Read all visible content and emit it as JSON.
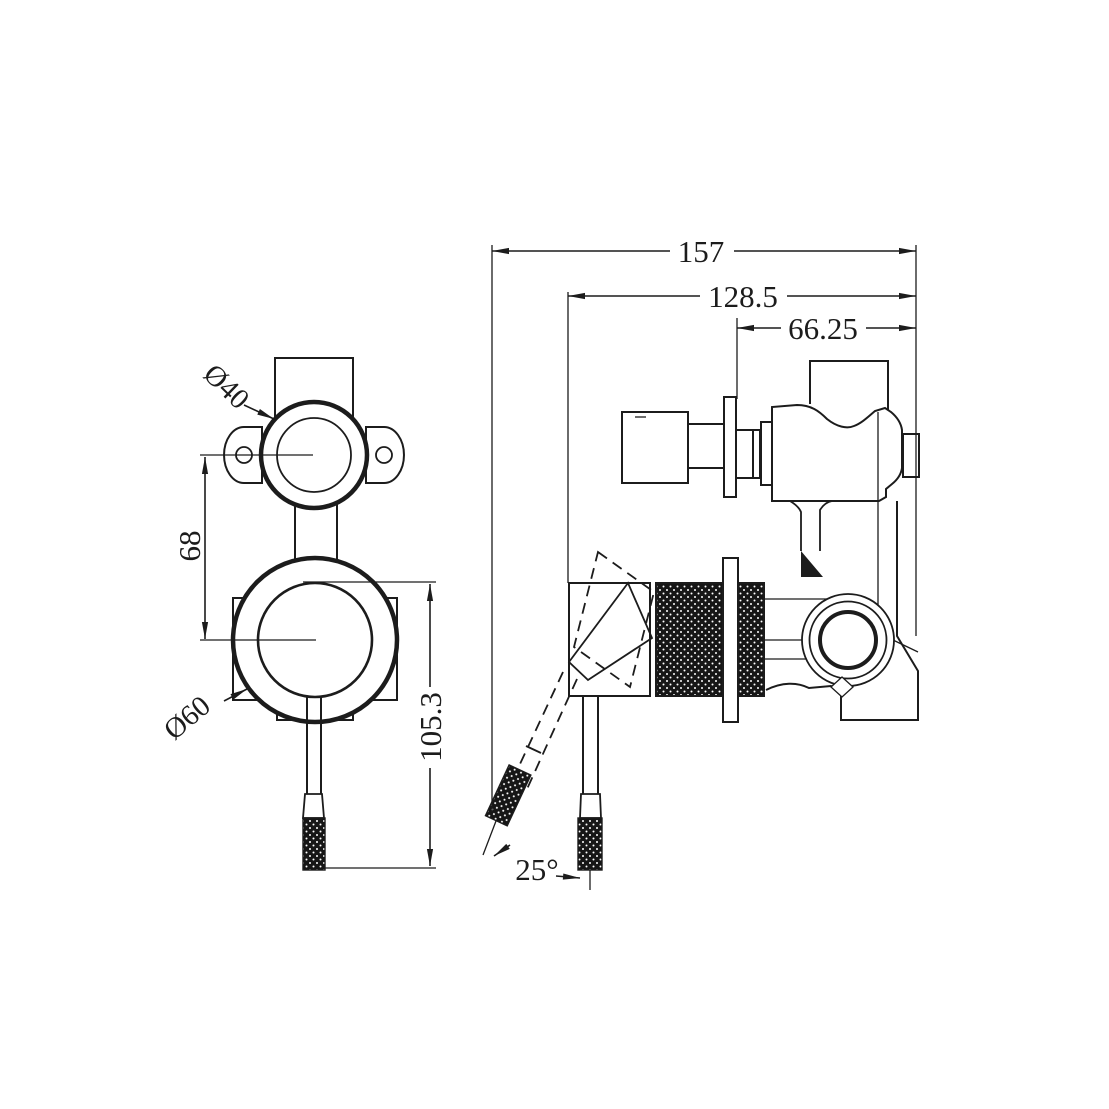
{
  "page": {
    "background": "#ffffff",
    "ink": "#1c1c1c"
  },
  "drawing": {
    "type": "technical-orthographic-drawing",
    "subject": "wall-mounted-mixer-with-diverter",
    "dimensions": {
      "overall_depth": "157",
      "handle_plate_depth": "128.5",
      "wall_to_outlet": "66.25",
      "port_centre_spacing": "68",
      "handle_length": "105.3",
      "diverter_trim_diameter": "Ø40",
      "mixer_trim_diameter": "Ø60",
      "lever_angle": "25°"
    }
  }
}
